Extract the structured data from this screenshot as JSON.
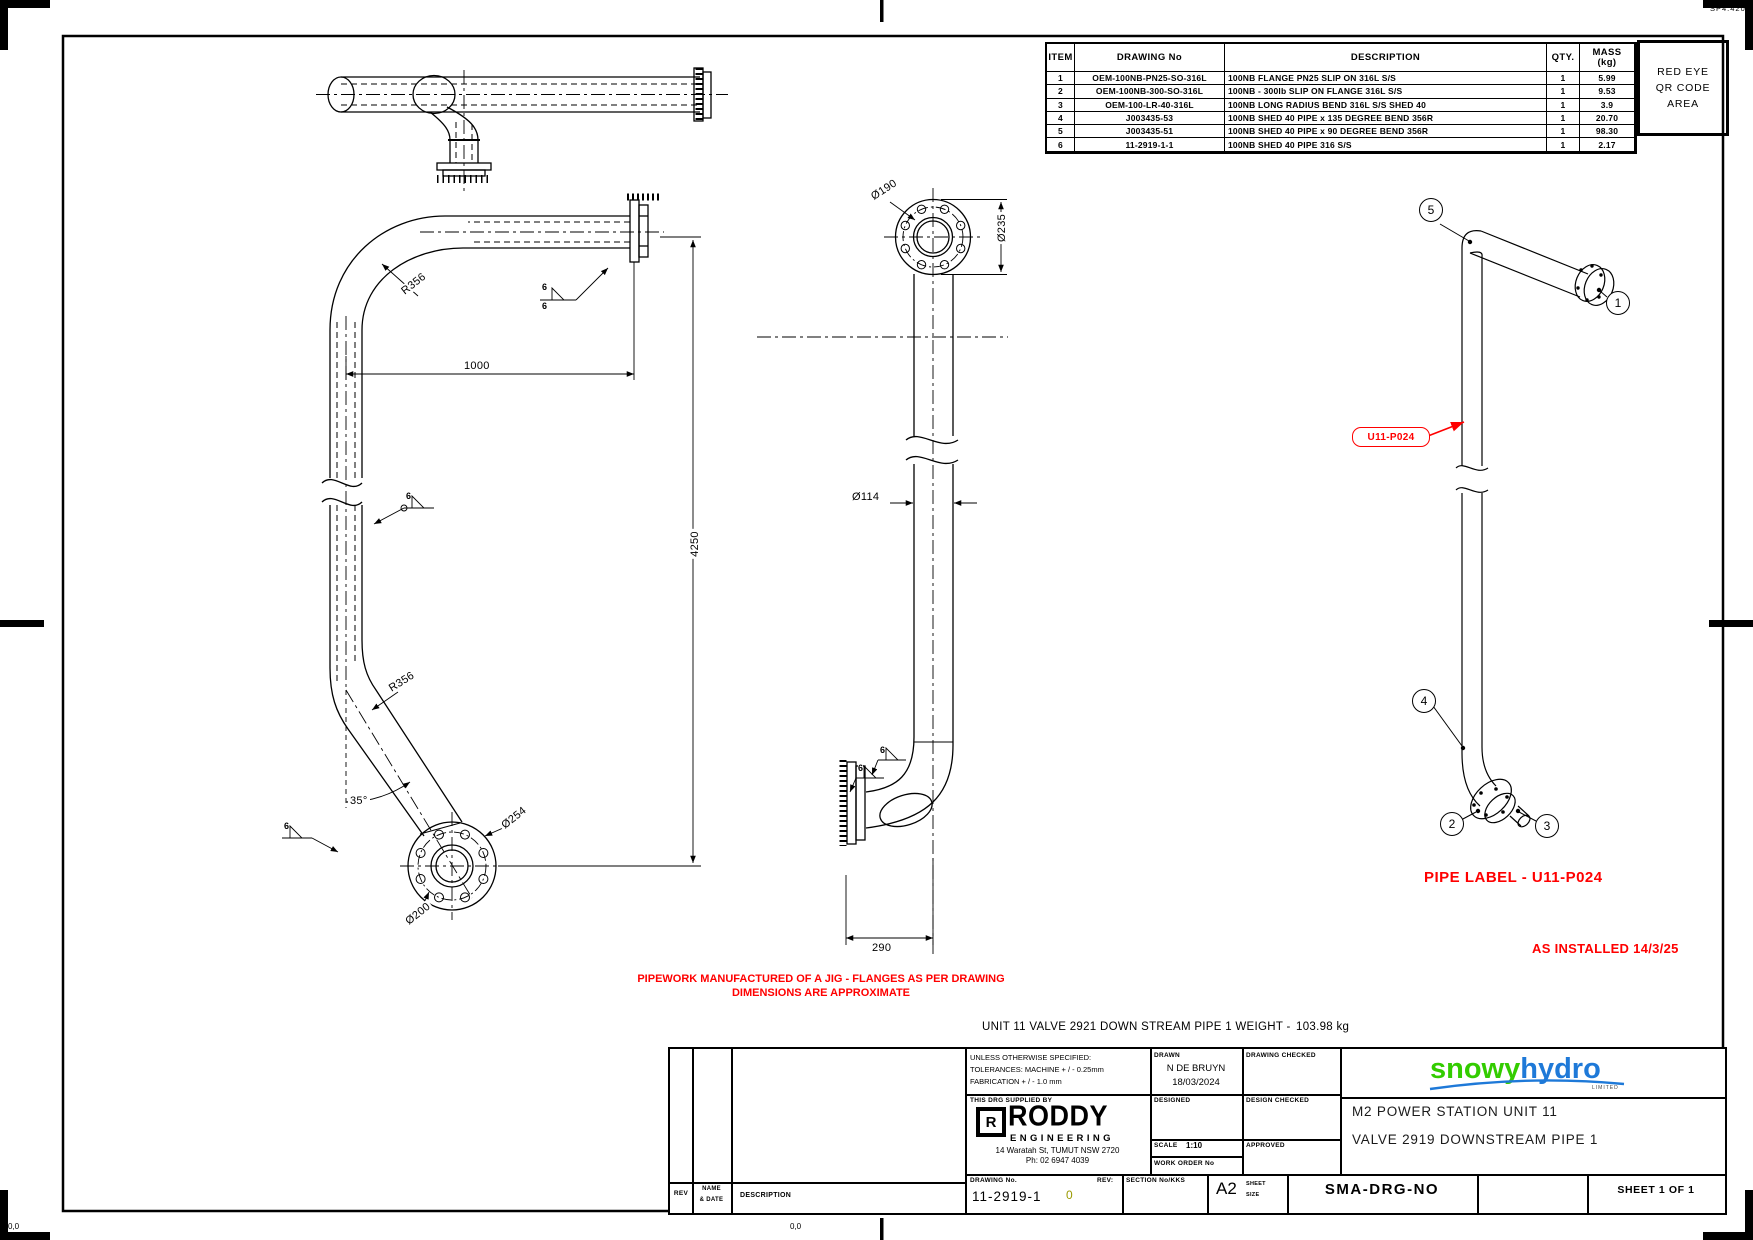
{
  "page": {
    "plot_ref": "SP4.420",
    "origin_marker_left": "0,0",
    "origin_marker_right": "0,0"
  },
  "colors": {
    "line": "#000000",
    "note_red": "#FF0000",
    "logo_green": "#33CC00",
    "logo_blue": "#1E79D8",
    "rev_olive": "#9A9A00"
  },
  "bom": {
    "headers": {
      "item": "ITEM",
      "drawing_no": "DRAWING No",
      "description": "DESCRIPTION",
      "qty": "QTY.",
      "mass_line1": "MASS",
      "mass_line2": "(kg)"
    },
    "rows": [
      {
        "item": "1",
        "drawing_no": "OEM-100NB-PN25-SO-316L",
        "description": "100NB FLANGE PN25 SLIP ON 316L S/S",
        "qty": "1",
        "mass": "5.99"
      },
      {
        "item": "2",
        "drawing_no": "OEM-100NB-300-SO-316L",
        "description": "100NB - 300lb SLIP ON FLANGE 316L S/S",
        "qty": "1",
        "mass": "9.53"
      },
      {
        "item": "3",
        "drawing_no": "OEM-100-LR-40-316L",
        "description": "100NB LONG RADIUS BEND 316L S/S SHED 40",
        "qty": "1",
        "mass": "3.9"
      },
      {
        "item": "4",
        "drawing_no": "J003435-53",
        "description": "100NB SHED 40 PIPE x 135 DEGREE BEND 356R",
        "qty": "1",
        "mass": "20.70"
      },
      {
        "item": "5",
        "drawing_no": "J003435-51",
        "description": "100NB SHED 40 PIPE x 90 DEGREE BEND 356R",
        "qty": "1",
        "mass": "98.30"
      },
      {
        "item": "6",
        "drawing_no": "11-2919-1-1",
        "description": "100NB SHED 40 PIPE 316 S/S",
        "qty": "1",
        "mass": "2.17"
      }
    ]
  },
  "qr_area": {
    "line1": "RED EYE",
    "line2": "QR CODE",
    "line3": "AREA"
  },
  "annotations": {
    "weld_fillet_size": "6",
    "elevation": {
      "r356_top": "R356",
      "dim_1000": "1000",
      "dim_4250": "4250",
      "r356_bottom": "R356",
      "angle_35": "35°",
      "dia_254": "Ø254",
      "dia_200": "Ø200"
    },
    "front": {
      "dia_190": "Ø190",
      "dia_235": "Ø235",
      "dia_114": "Ø114",
      "dim_290": "290"
    },
    "installed": {
      "balloon_1": "1",
      "balloon_2": "2",
      "balloon_3": "3",
      "balloon_4": "4",
      "balloon_5": "5",
      "pipe_tag": "U11-P024"
    }
  },
  "notes": {
    "jig_line1": "PIPEWORK MANUFACTURED OF A JIG - FLANGES AS PER DRAWING",
    "jig_line2": "DIMENSIONS ARE APPROXIMATE",
    "weight_label": "UNIT 11 VALVE 2921 DOWN STREAM PIPE 1 WEIGHT -",
    "weight_value": "103.98 kg",
    "pipe_label": "PIPE LABEL - U11-P024",
    "as_installed": "AS INSTALLED 14/3/25"
  },
  "title_block": {
    "tolerances_line1": "UNLESS OTHERWISE SPECIFIED:",
    "tolerances_line2": "TOLERANCES: MACHINE + / - 0.25mm",
    "tolerances_line3": "FABRICATION + / - 1.0 mm",
    "supplied_by_label": "THIS DRG SUPPLIED BY",
    "roddy_r": "R",
    "roddy_name": "RODDY",
    "roddy_sub": "ENGINEERING",
    "roddy_address": "14 Waratah St, TUMUT NSW 2720",
    "roddy_phone": "Ph: 02 6947 4039",
    "drawing_no_label": "DRAWING No.",
    "drawing_no": "11-2919-1",
    "rev_label": "REV:",
    "rev_value": "0",
    "drawn_label": "DRAWN",
    "drawn_name": "N DE BRUYN",
    "drawn_date": "18/03/2024",
    "drawing_checked_label": "DRAWING CHECKED",
    "designed_label": "DESIGNED",
    "design_checked_label": "DESIGN CHECKED",
    "scale_label": "SCALE",
    "scale_value": "1:10",
    "work_order_label": "WORK ORDER No",
    "approved_label": "APPROVED",
    "section_label": "SECTION No/KKS",
    "paper_size": "A2",
    "sheet_label": "SHEET",
    "size_label": "SIZE",
    "sma": "SMA-DRG-NO",
    "sheet_of": "SHEET 1 OF 1",
    "title_line1": "M2 POWER STATION UNIT 11",
    "title_line2": "VALVE 2919 DOWNSTREAM PIPE 1",
    "logo_snowy": "snowy",
    "logo_hydro": "hydro",
    "logo_limited": "LIMITED",
    "rev_col": "REV",
    "name_col_line1": "NAME",
    "name_col_line2": "& DATE",
    "desc_col": "DESCRIPTION"
  }
}
